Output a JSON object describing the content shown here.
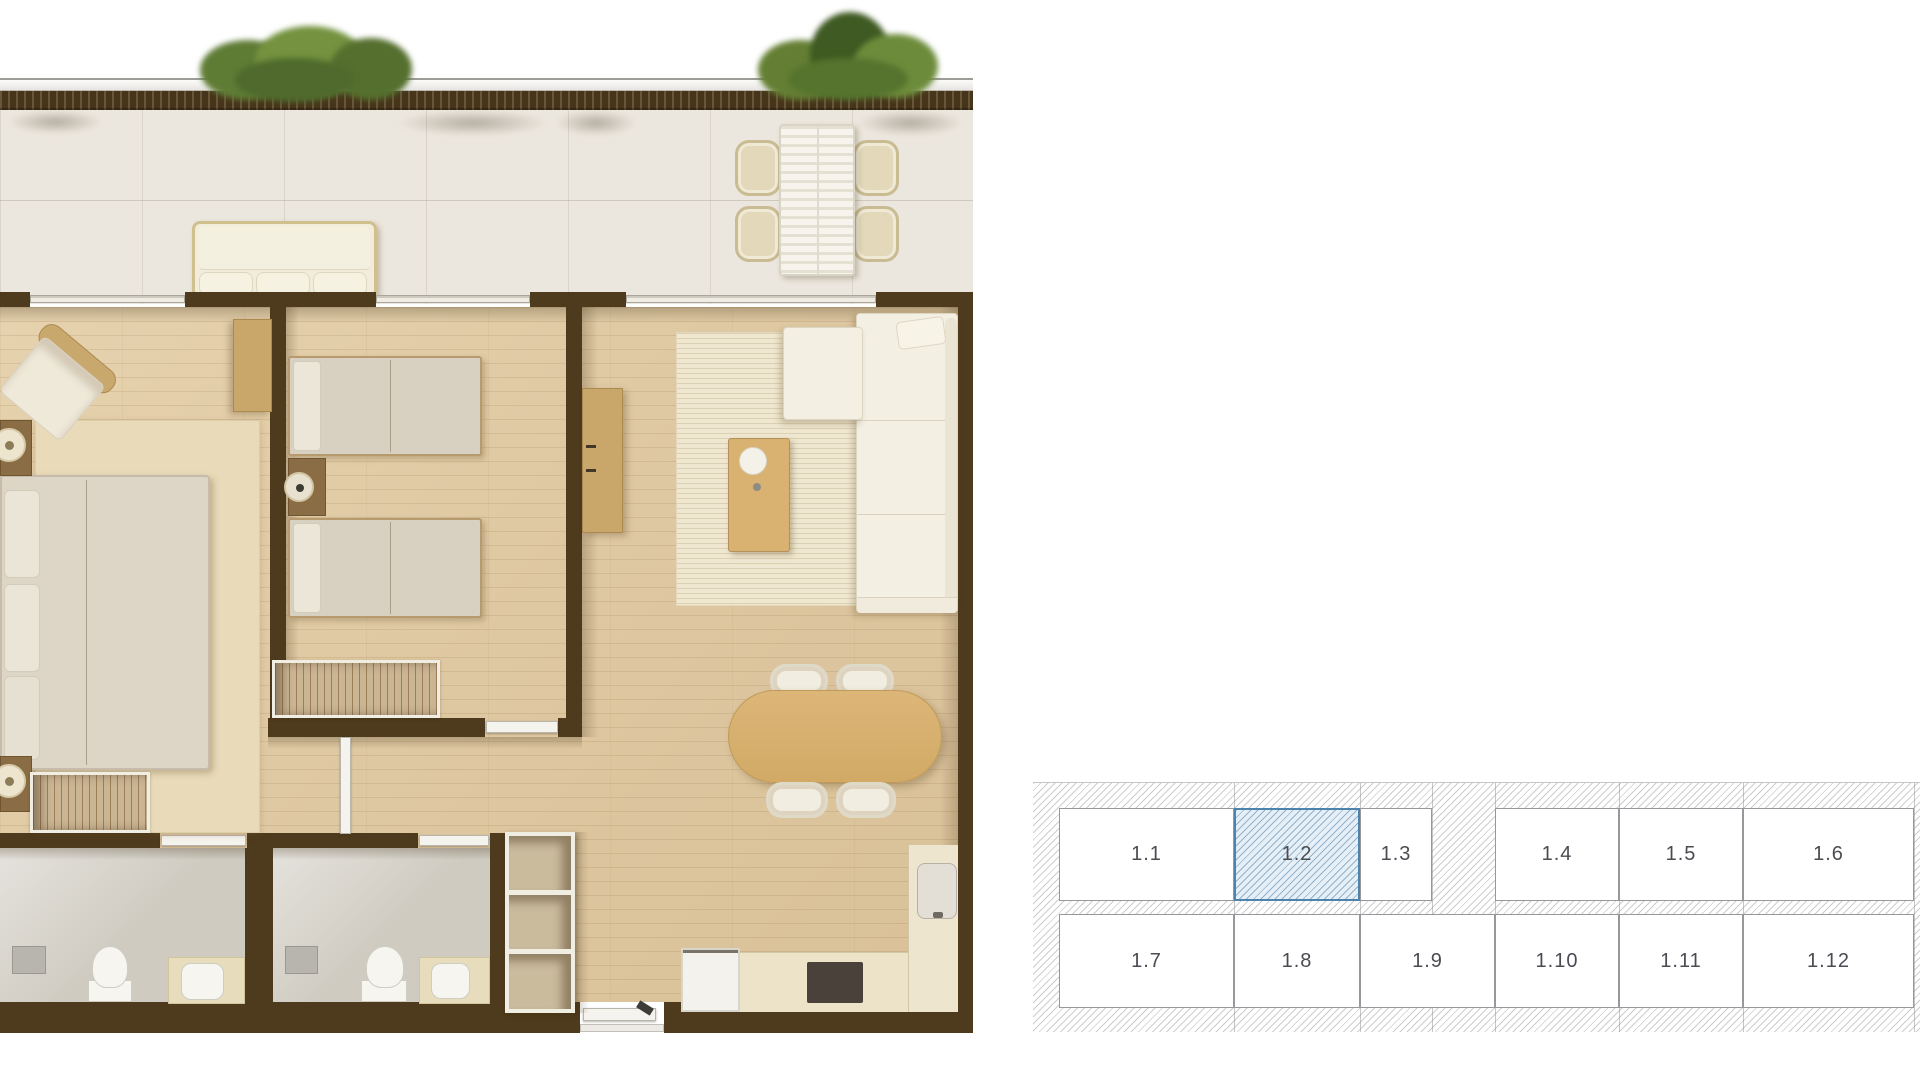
{
  "unit_map": {
    "selected_unit": "1.2",
    "row1": [
      "1.1",
      "1.2",
      "1.3",
      "1.4",
      "1.5",
      "1.6"
    ],
    "row2": [
      "1.7",
      "1.8",
      "1.9",
      "1.10",
      "1.11",
      "1.12"
    ],
    "colors": {
      "hatch_line": "#cdcdcd",
      "grid_line": "#96989c",
      "label": "#4a4c52",
      "selected_border": "#4c84ad",
      "selected_fill": "#e7eff6",
      "selected_hatch_line": "#8fb3cf"
    }
  },
  "floor_plan": {
    "colors": {
      "wall": "#4e3a1c",
      "floor": "#dfc9a3",
      "terrace_floor": "#ece7de",
      "planter": "#46351a",
      "plant_green": "#6b8a3e",
      "rug_master": "#e9dbb9",
      "rug_living": "#efe7d0",
      "upholstery": "#f2eede",
      "bedding": "#d8d1c1",
      "wood_furniture": "#c9a76b",
      "table_wood": "#d9b272",
      "bathroom_floor": "#cfcbc1",
      "fixture_white": "#f6f5f0",
      "counter": "#ece3c9",
      "cooktop": "#49413a",
      "door_leaf": "#f5f3ed"
    }
  }
}
